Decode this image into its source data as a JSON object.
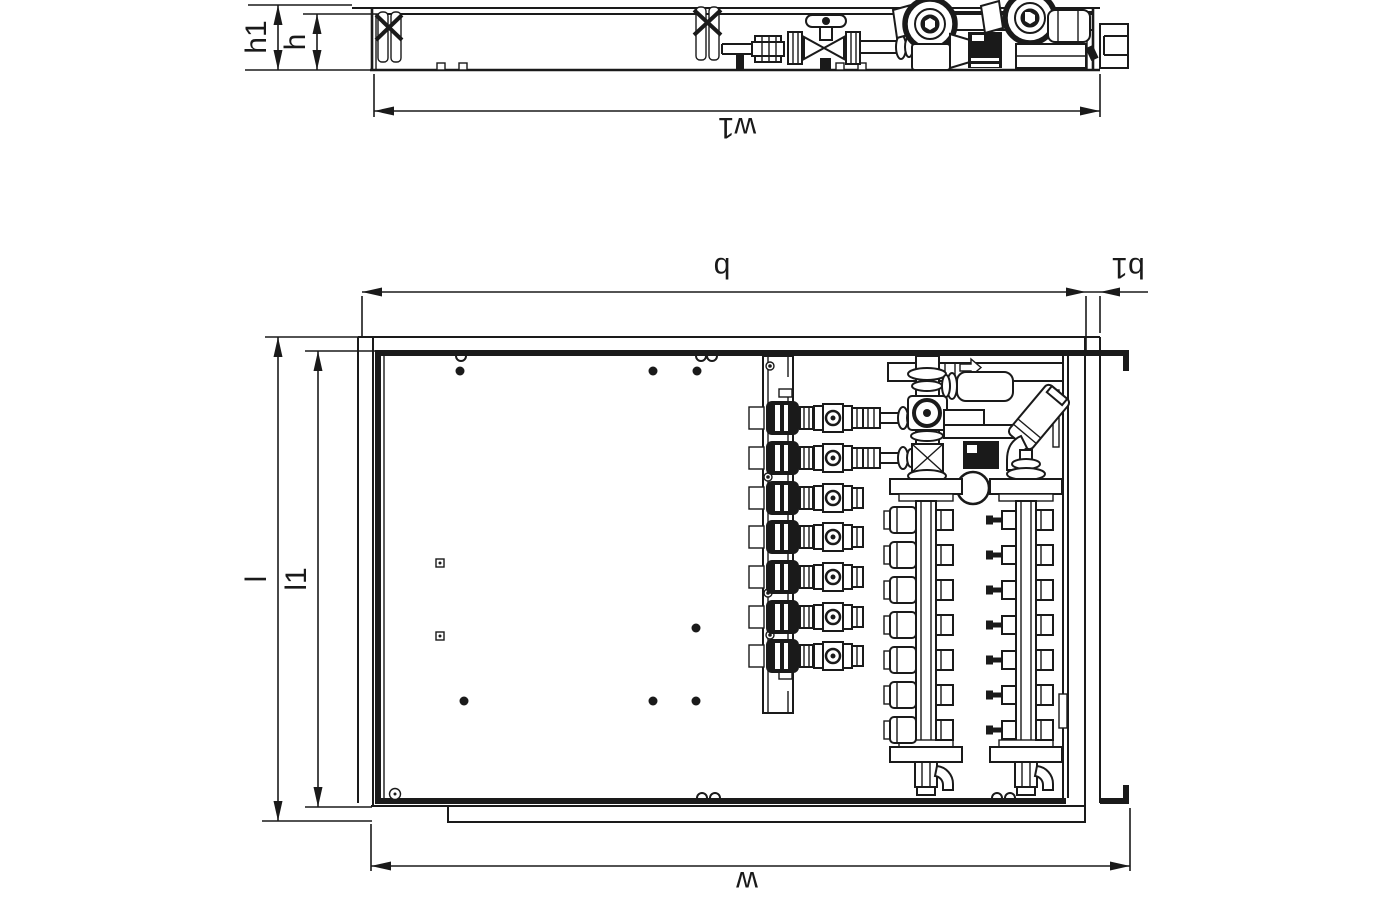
{
  "page": {
    "type": "technical dimensional line drawing",
    "background": "#ffffff",
    "line_color": "#1a1a1a",
    "views": [
      "top view of cabinet",
      "front view of open manifold cabinet"
    ]
  },
  "labels": {
    "h1": "h1",
    "h": "h",
    "w1": "w1",
    "b": "b",
    "b1": "b1",
    "l": "l",
    "l1": "l1",
    "w": "w"
  }
}
